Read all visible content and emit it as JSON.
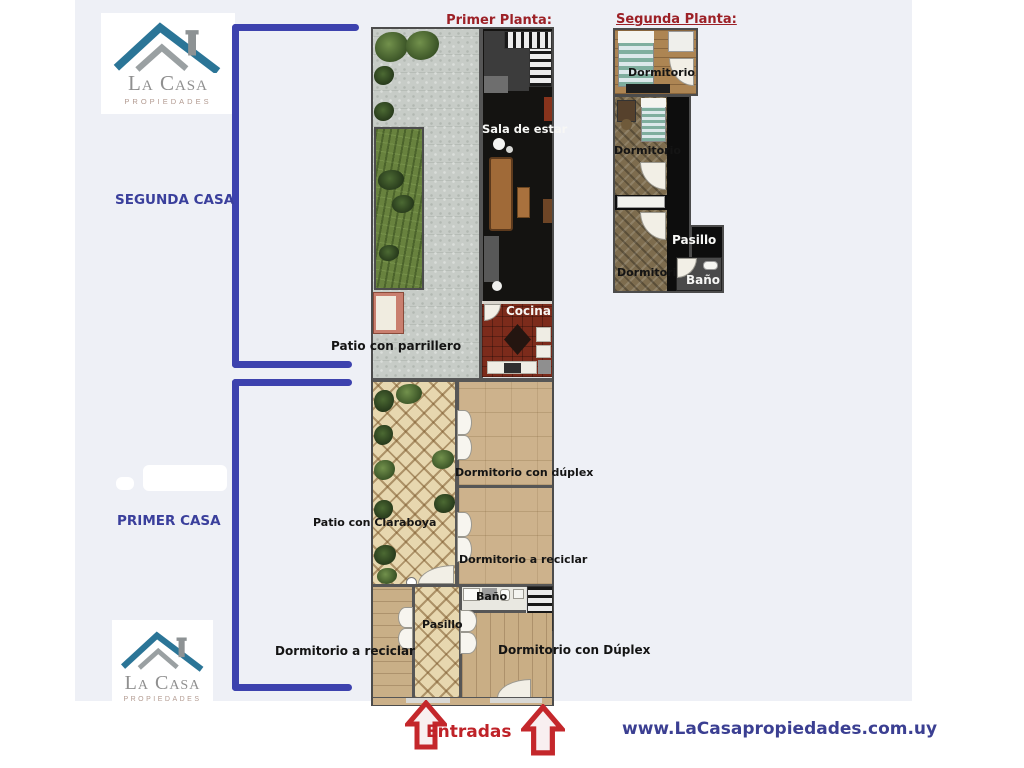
{
  "brand": {
    "name_line1": "La Casa",
    "name_line2": "PROPIEDADES",
    "website": "www.LaCasapropiedades.com.uy"
  },
  "annotations": {
    "segunda_casa": "SEGUNDA CASA",
    "primer_casa": "PRIMER CASA",
    "entradas": "Entradas"
  },
  "colors": {
    "bracket_blue": "#3d42ae",
    "annotation_navy": "#3a3f9c",
    "title_red": "#9c2026",
    "entradas_red": "#bf2228",
    "website_navy": "#3b3f92",
    "panel_background": "#eef0f6"
  },
  "primer_planta": {
    "title": "Primer Planta:",
    "labels": {
      "sala_de_estar": "Sala de estar",
      "cocina": "Cocina",
      "patio_parrillero": "Patio con parrillero",
      "patio_claraboya": "Patio con Claraboya",
      "dormitorio_duplex_1": "Dormitorio con dúplex",
      "dormitorio_reciclar_1": "Dormitorio a reciclar",
      "dormitorio_reciclar_2": "Dormitorio a reciclar",
      "pasillo": "Pasillo",
      "bano": "Baño",
      "dormitorio_duplex_2": "Dormitorio con Dúplex"
    }
  },
  "segunda_planta": {
    "title": "Segunda Planta:",
    "labels": {
      "dormitorio_1": "Dormitorio",
      "dormitorio_2": "Dormitorio",
      "dormitorio_3": "Dormitorio",
      "pasillo": "Pasillo",
      "bano": "Baño"
    }
  }
}
